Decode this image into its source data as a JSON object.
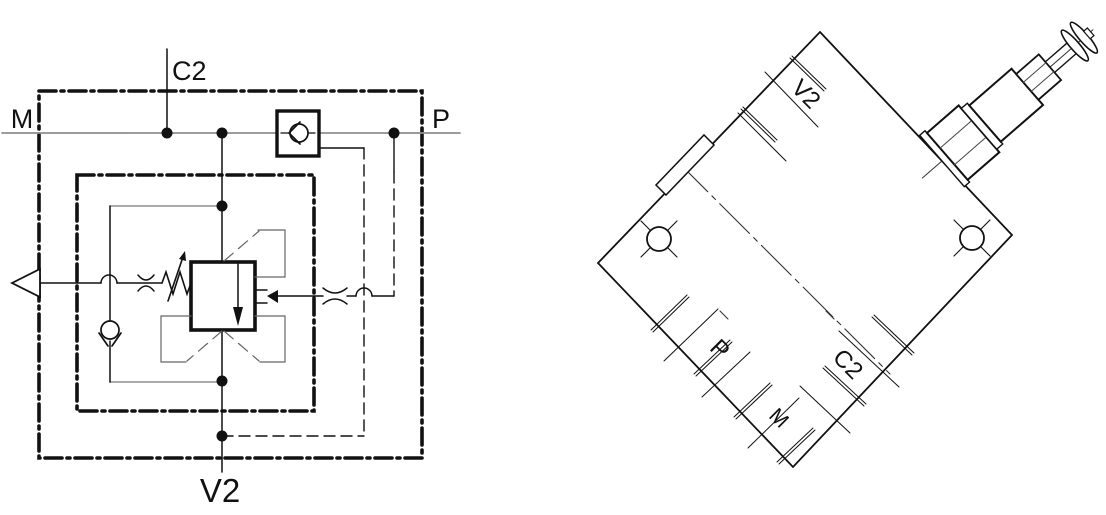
{
  "canvas": {
    "width": 1106,
    "height": 515,
    "background": "#ffffff"
  },
  "colors": {
    "ink": "#111111",
    "hairline": "#8f8f8f",
    "bracket": "#666666"
  },
  "schematic": {
    "ports": {
      "m": "M",
      "c2": "C2",
      "p": "P",
      "v2": "V2"
    },
    "symbols": [
      "enclosure-dashdot-boundary",
      "inner-cartridge-boundary",
      "pressure-valve-square",
      "flow-arrow",
      "pilot-arrow",
      "adjustable-spring",
      "orifice-restriction",
      "check-valve-ball",
      "inline-check-valve",
      "vent-triangle",
      "line-crossover-hop",
      "junction-dot",
      "pilot-dashed-line"
    ]
  },
  "body": {
    "ports": {
      "v2": "V2",
      "p": "P",
      "m": "M",
      "c2": "C2"
    },
    "features": [
      "valve-block-outline",
      "mounting-hole-cross",
      "port-counterbore-ticks",
      "port-boss",
      "cavity-centerline",
      "adjustment-screw-assembly"
    ]
  }
}
